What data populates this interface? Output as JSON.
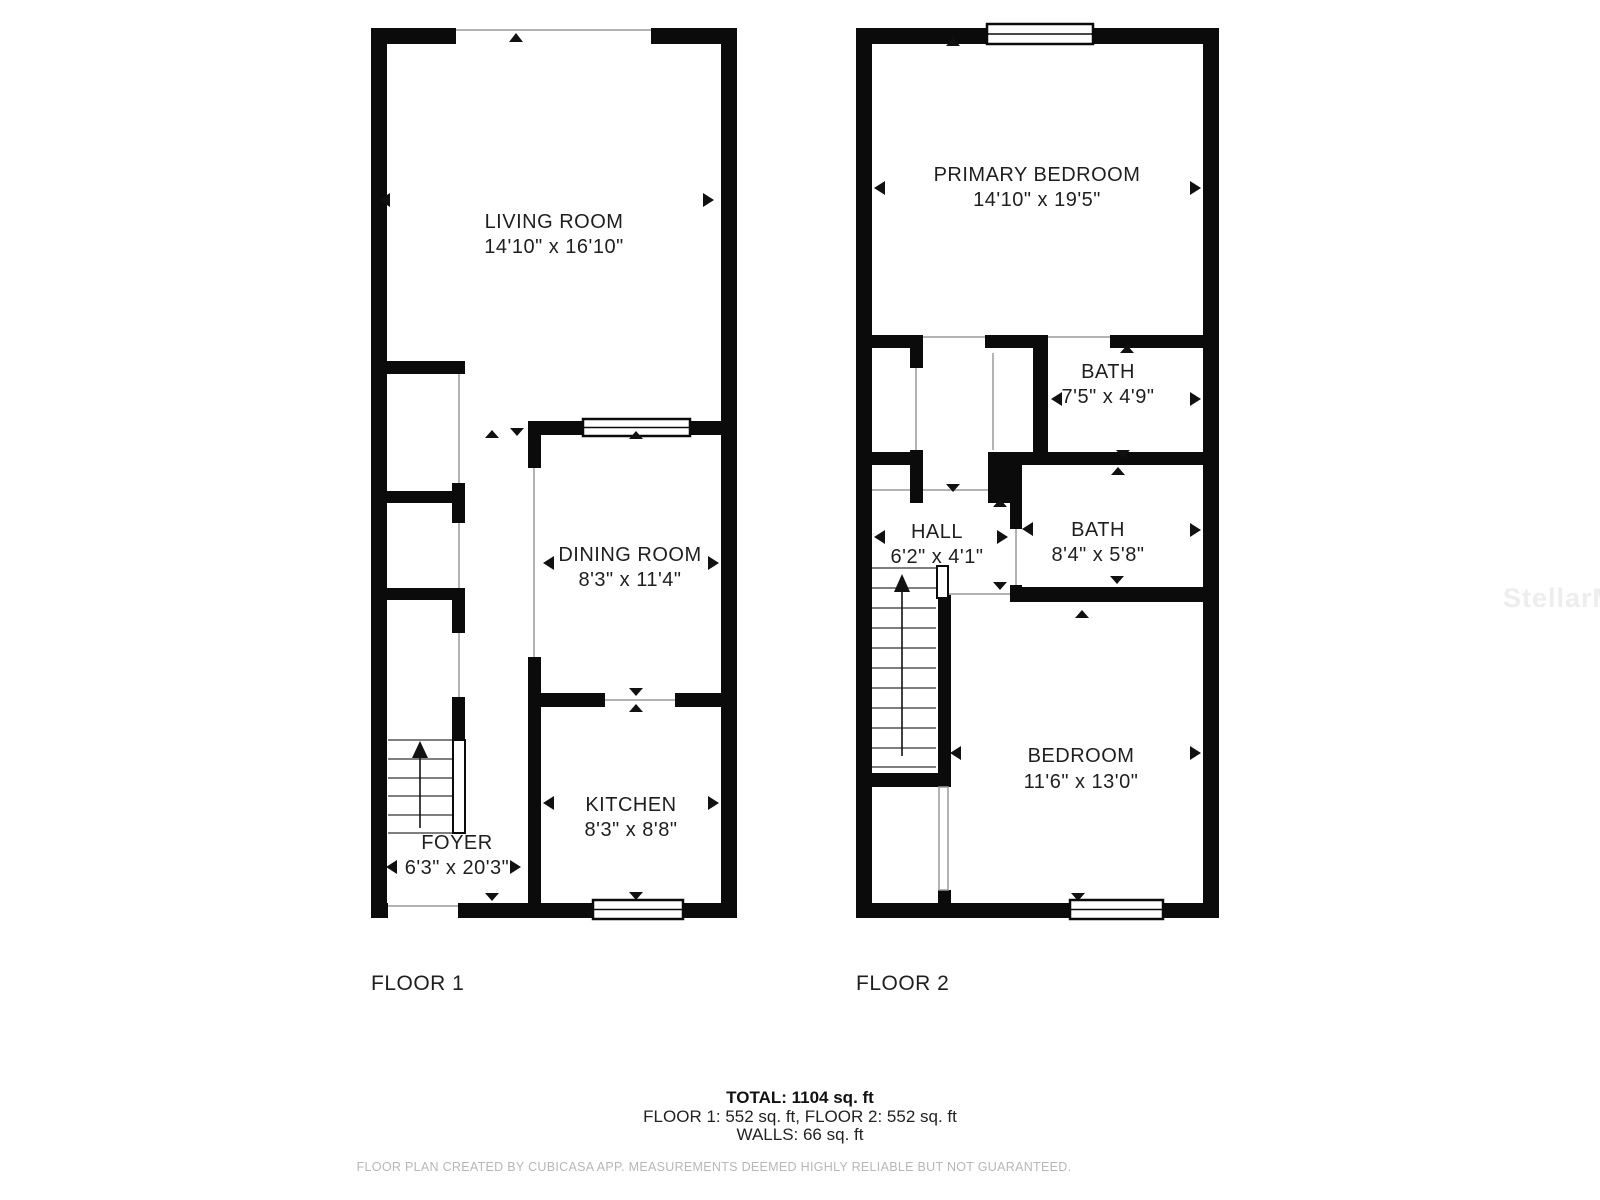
{
  "watermark": "StellarMLS",
  "floor1": {
    "label": "FLOOR 1",
    "rooms": {
      "living": {
        "name": "LIVING ROOM",
        "dims": "14'10\" x 16'10\""
      },
      "dining": {
        "name": "DINING ROOM",
        "dims": "8'3\" x 11'4\""
      },
      "kitchen": {
        "name": "KITCHEN",
        "dims": "8'3\" x 8'8\""
      },
      "foyer": {
        "name": "FOYER",
        "dims": "6'3\" x 20'3\""
      }
    }
  },
  "floor2": {
    "label": "FLOOR 2",
    "rooms": {
      "primary": {
        "name": "PRIMARY BEDROOM",
        "dims": "14'10\" x 19'5\""
      },
      "bath1": {
        "name": "BATH",
        "dims": "7'5\" x 4'9\""
      },
      "bath2": {
        "name": "BATH",
        "dims": "8'4\" x 5'8\""
      },
      "hall": {
        "name": "HALL",
        "dims": "6'2\" x 4'1\""
      },
      "bedroom": {
        "name": "BEDROOM",
        "dims": "11'6\" x 13'0\""
      }
    }
  },
  "summary": {
    "total": "TOTAL: 1104 sq. ft",
    "floors": "FLOOR 1: 552 sq. ft, FLOOR 2: 552 sq. ft",
    "walls": "WALLS: 66 sq. ft"
  },
  "footer": "FLOOR PLAN CREATED BY CUBICASA APP. MEASUREMENTS DEEMED HIGHLY RELIABLE BUT NOT GUARANTEED."
}
